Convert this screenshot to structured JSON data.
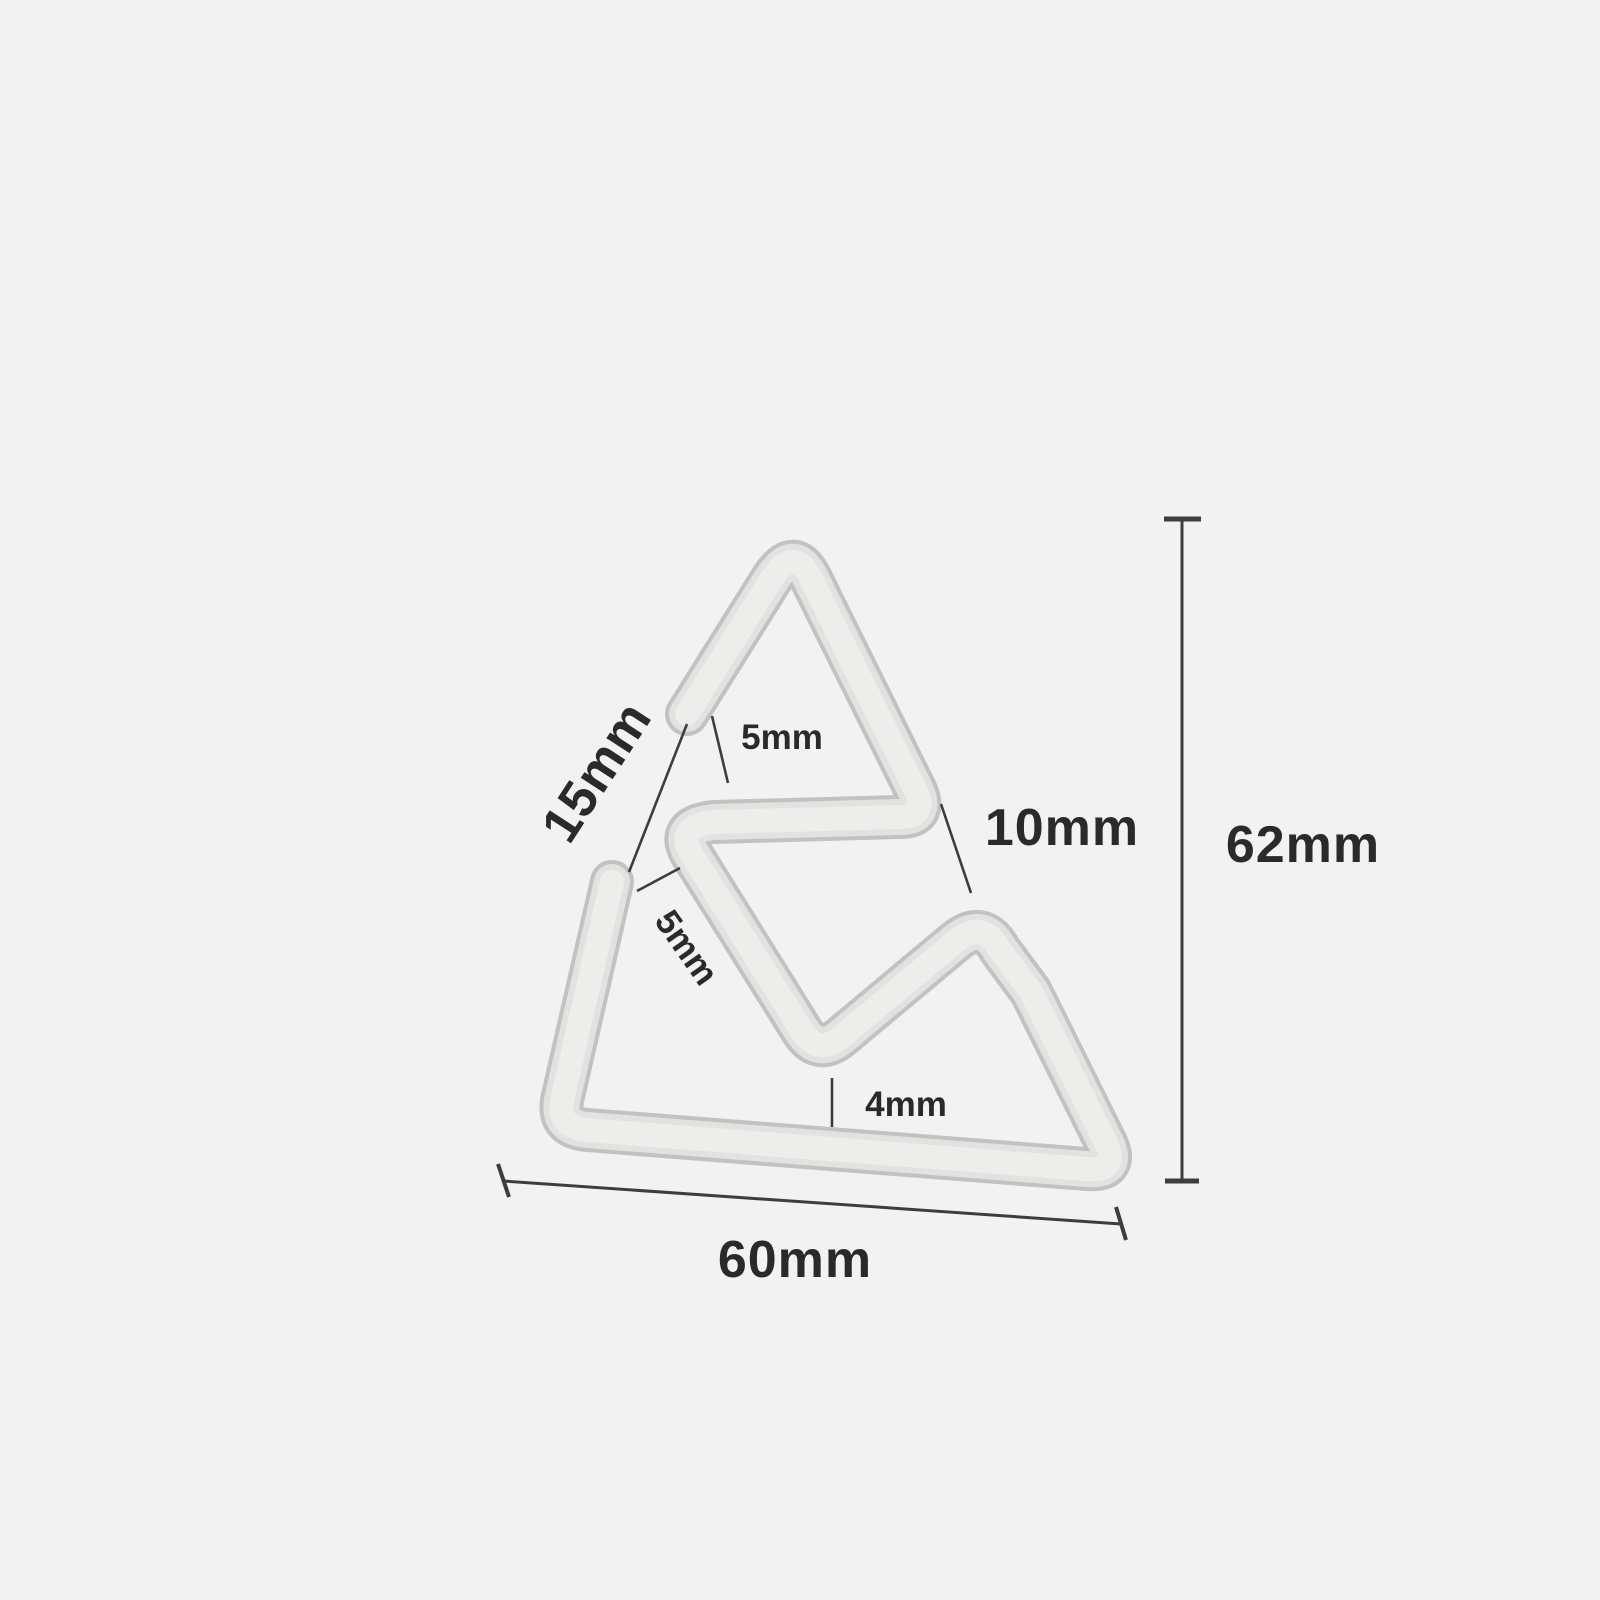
{
  "page": {
    "background_color": "#f2f2f3",
    "type": "product-dimension-diagram"
  },
  "product": {
    "name": "triangular wire buckle",
    "body_color": "#e2e2e1",
    "edge_color": "#c2c2c1",
    "highlight_color": "#ededec"
  },
  "annotations": {
    "line_color": "#3d3d3d",
    "text_color": "#2a2a2a",
    "labels": {
      "gap_between_ends": "15mm",
      "top_end_clearance": "5mm",
      "side_end_clearance": "5mm",
      "right_inner_clearance": "10mm",
      "overall_height": "62mm",
      "overall_width": "60mm",
      "bottom_inner_clearance": "4mm"
    }
  }
}
